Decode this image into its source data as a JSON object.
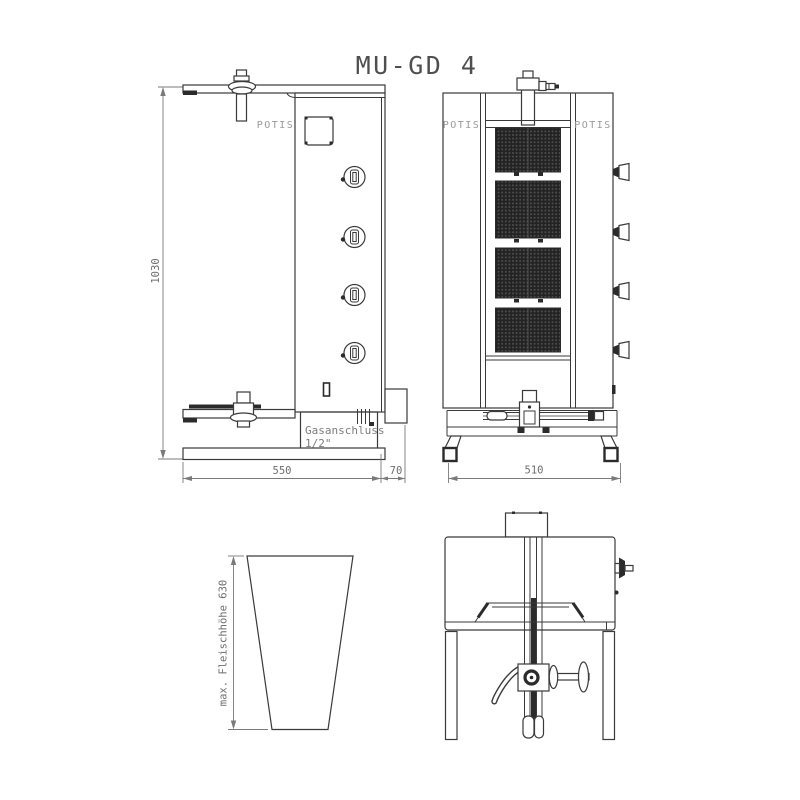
{
  "title": "MU-GD 4",
  "side_view": {
    "brand_label": "POTIS",
    "gas_connection_line1": "Gasanschluss",
    "gas_connection_line2": "1/2\"",
    "dim_height": "1030",
    "dim_depth_body": "550",
    "dim_depth_rear": "70"
  },
  "front_view": {
    "brand_label_left": "POTIS",
    "brand_label_right": "POTIS",
    "dim_width": "510"
  },
  "cone_view": {
    "dim_label": "max. Fleischhöhe 630"
  },
  "colors": {
    "line": "#3a3a3a",
    "dark_fill": "#2b2b2b",
    "dimension": "#7a7a7a",
    "brand_text": "#9a9a9a"
  }
}
